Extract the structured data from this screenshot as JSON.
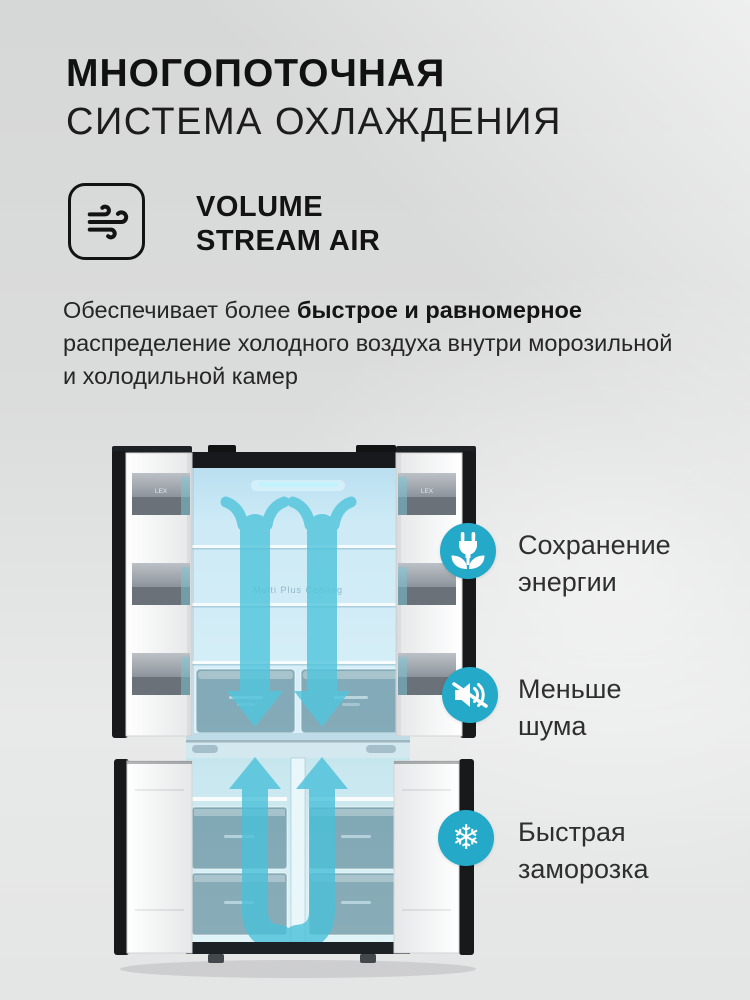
{
  "header": {
    "title_bold": "МНОГОПОТОЧНАЯ",
    "title_light": "СИСТЕМА ОХЛАЖДЕНИЯ"
  },
  "airflow_badge": {
    "icon": "wind-icon",
    "line1": "VOLUME",
    "line2": "STREAM AIR"
  },
  "description": {
    "line1_normal": "Обеспечивает более ",
    "line1_bold": "быстрое и равномерное",
    "line2": "распределение холодного воздуха внутри морозильной",
    "line3": "и холодильной камер"
  },
  "fridge": {
    "brand": "LEX",
    "interior_label": "Multi Plus Cooling",
    "type": "four-door cross refrigerator, doors open, cooling airflow arrows"
  },
  "callouts": [
    {
      "icon": "energy-saving-plug-leaf-icon",
      "line1": "Сохранение",
      "line2": "энергии"
    },
    {
      "icon": "low-noise-muted-speaker-icon",
      "line1": "Меньше",
      "line2": "шума"
    },
    {
      "icon": "fast-freeze-snowflake-icon",
      "line1": "Быстрая",
      "line2": "заморозка",
      "glyph": "❄"
    }
  ],
  "colors": {
    "accent_teal": "#24aac8",
    "arrow_cyan": "#52c5dc",
    "interior_blue": "#cfeaf6",
    "background_gray": "#dbdcdc",
    "door_black": "#17191b",
    "title_black": "#111111"
  }
}
